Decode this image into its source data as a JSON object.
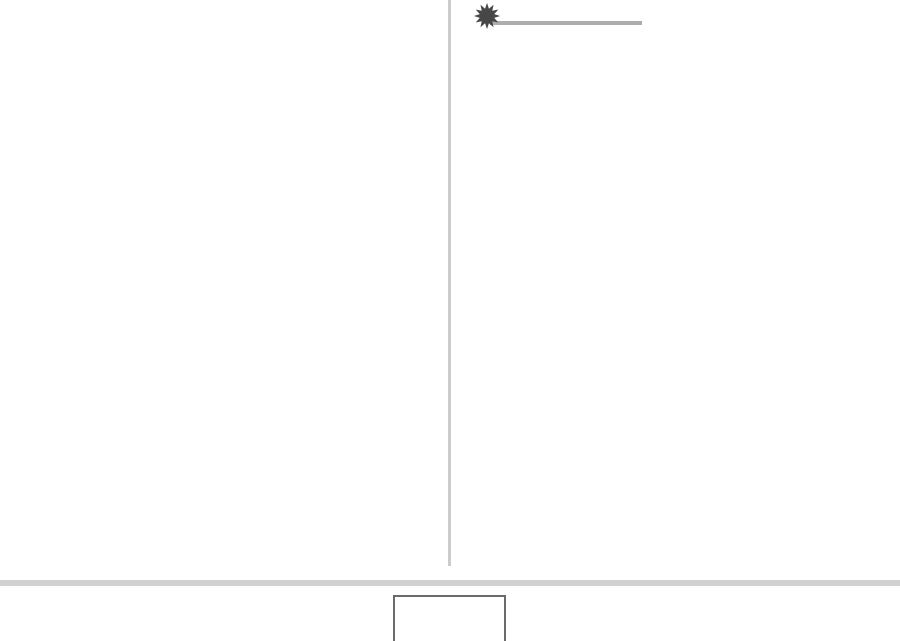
{
  "page": {
    "type": "blank-two-column-page",
    "text_content": "",
    "left_column": {
      "content": ""
    },
    "right_column": {
      "marker": {
        "icon": "starburst-icon",
        "glyph": "✹",
        "points": 12
      }
    },
    "footer": {
      "box_label": ""
    }
  },
  "colors": {
    "page-background": "#ffffff",
    "divider-color": "#cccccc",
    "rule-color": "#adadad",
    "starburst-color": "#474747",
    "footer-bar-color": "#d2d2d2",
    "box-border-color": "#6a6a6a",
    "box-fill-color": "#ffffff"
  }
}
